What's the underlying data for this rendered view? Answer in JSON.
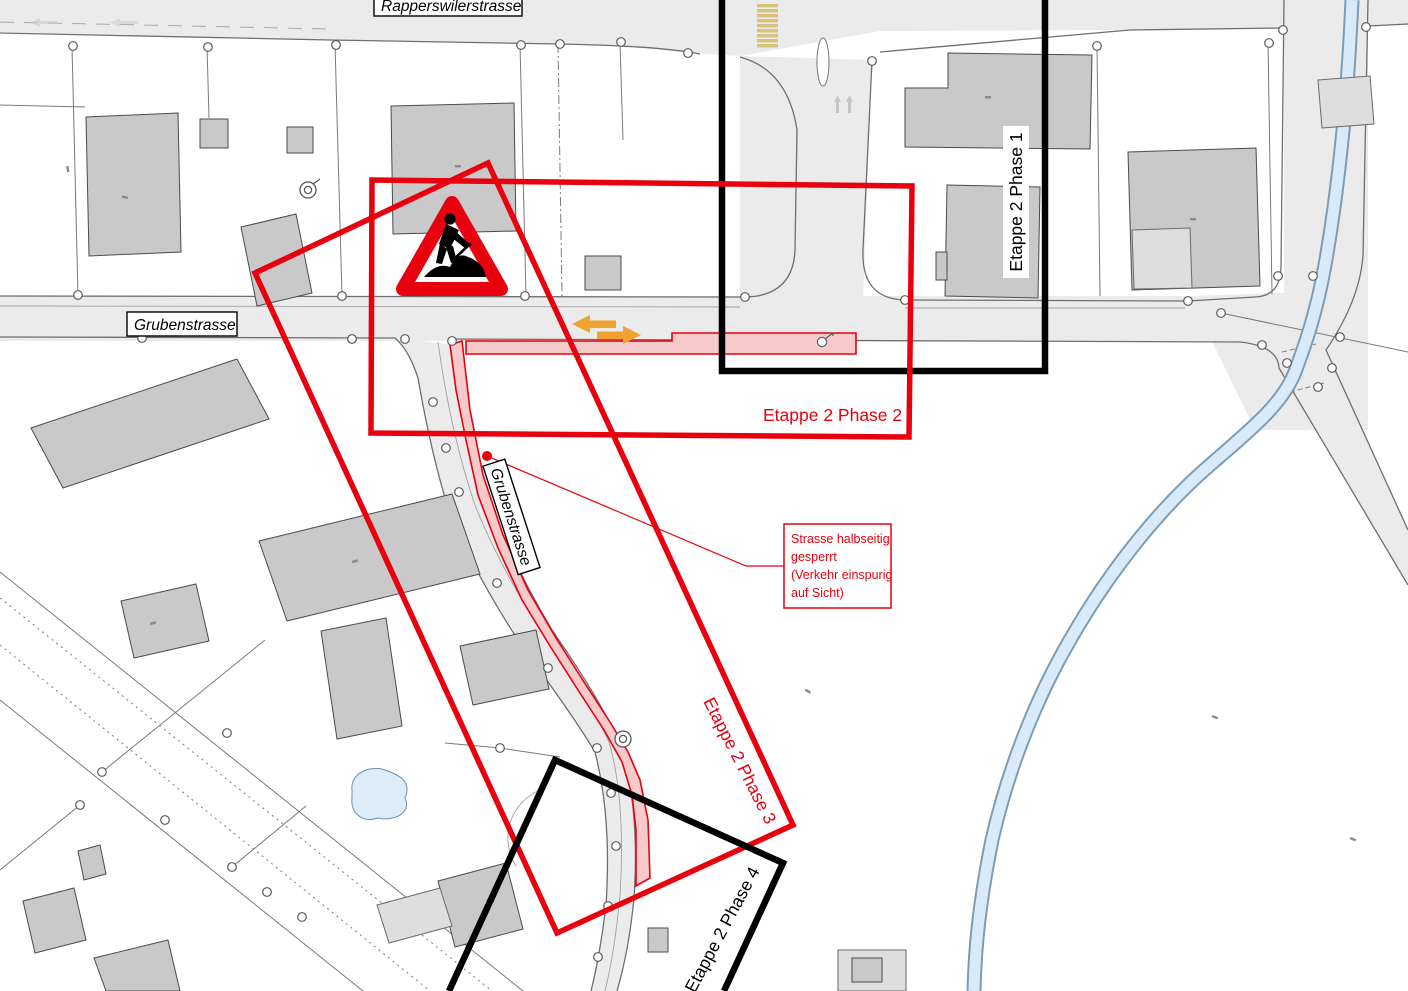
{
  "document": {
    "type": "construction-phasing-site-plan",
    "background": "#ffffff"
  },
  "streets": {
    "rapperswilerstrasse": "Rapperswilerstrasse",
    "grubenstrasse": "Grubenstrasse",
    "grubenstrasse_south": "Grubenstrasse"
  },
  "phases": [
    {
      "id": "phase-1",
      "label": "Etappe 2 Phase 1",
      "color": "#000000"
    },
    {
      "id": "phase-2",
      "label": "Etappe 2 Phase 2",
      "color": "#e8000f"
    },
    {
      "id": "phase-3",
      "label": "Etappe 2 Phase 3",
      "color": "#e8000f"
    },
    {
      "id": "phase-4",
      "label": "Etappe 2 Phase 4",
      "color": "#000000"
    }
  ],
  "annotation": {
    "lines": [
      "Strasse halbseitig",
      "gesperrt",
      "(Verkehr einspurig",
      "auf Sicht)"
    ],
    "color": "#e8000f"
  },
  "legend_colors": {
    "closure_zone_fill": "#f6caca",
    "closure_zone_border": "#e8000f",
    "traffic_arrows": "#f0a42f",
    "water": "#d9ebf9",
    "road": "#ebebeb",
    "building": "#c9c9c9",
    "crosswalk": "#d8c27c"
  },
  "icons": [
    {
      "name": "construction-warning-sign-icon"
    },
    {
      "name": "two-way-traffic-arrows-icon"
    },
    {
      "name": "survey-point-icon"
    },
    {
      "name": "crosswalk-icon"
    }
  ]
}
